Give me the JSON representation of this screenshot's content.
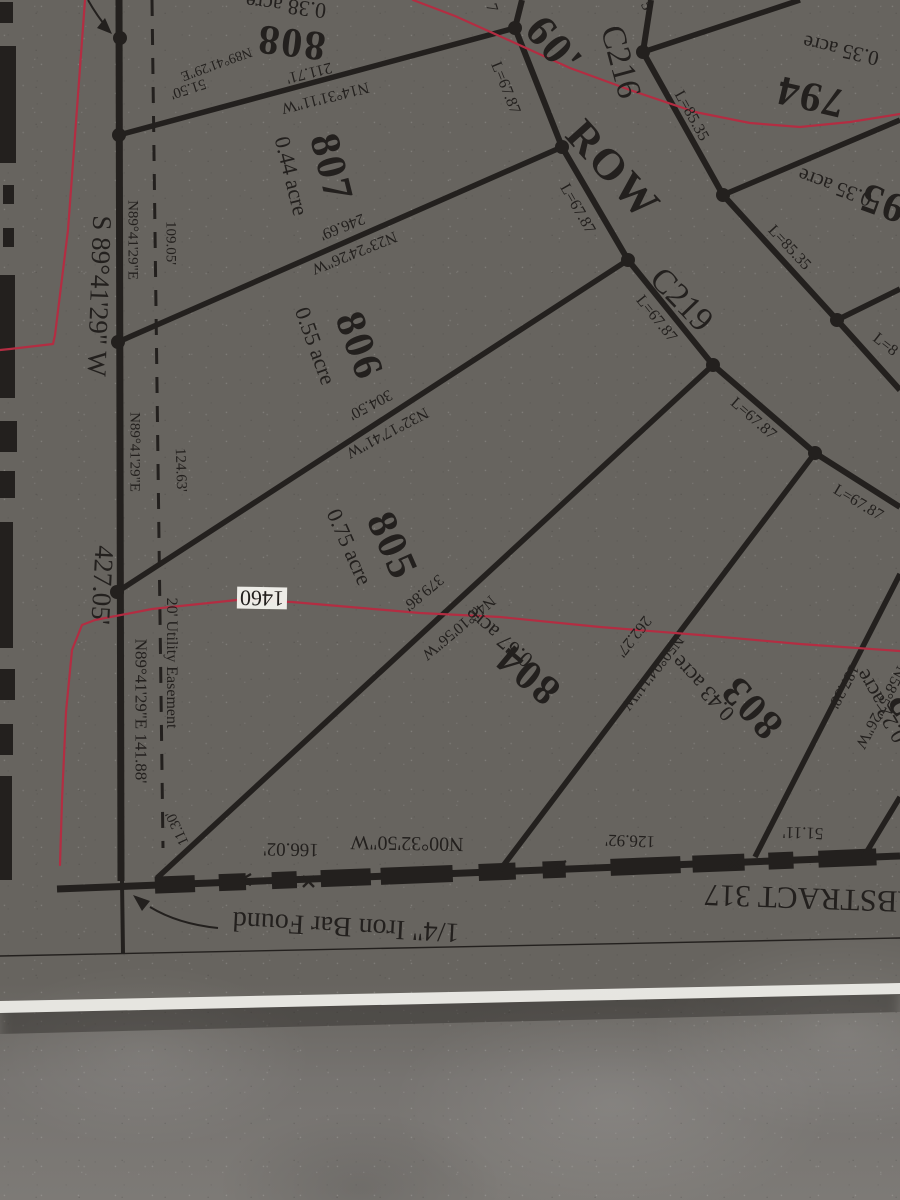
{
  "colors": {
    "ink": "#23201e",
    "red": "#b32d42",
    "paper": "#f1f0eb",
    "floor": "#67645f"
  },
  "map": {
    "type": "plat-survey-sheet",
    "street_curves": [
      "C216",
      "C219"
    ],
    "right_of_way": "60' ROW",
    "abstract": "ABSTRACT 317",
    "contour_elevation": "1460",
    "lots": [
      {
        "number": "794",
        "acreage": "0.35 acre"
      },
      {
        "number": "795",
        "acreage": "0.35 acre"
      },
      {
        "number": "802",
        "acreage": "0.22 acre"
      },
      {
        "number": "803",
        "acreage": "0.43 acre"
      },
      {
        "number": "804",
        "acreage": "0.67 acre"
      },
      {
        "number": "805",
        "acreage": "0.75 acre"
      },
      {
        "number": "806",
        "acreage": "0.55 acre"
      },
      {
        "number": "807",
        "acreage": "0.44 acre"
      },
      {
        "number": "808",
        "acreage": "0.38 acre"
      }
    ]
  },
  "labels": [
    {
      "name": "lot-808-number",
      "text": "808",
      "x": 291,
      "y": 42,
      "r": 187,
      "s": 42,
      "cls": "big"
    },
    {
      "name": "lot-808-acreage",
      "text": "0.38 acre",
      "x": 286,
      "y": 6,
      "r": 187,
      "s": 22
    },
    {
      "name": "lot-807-number",
      "text": "807",
      "x": 331,
      "y": 168,
      "r": 76,
      "s": 42,
      "cls": "big"
    },
    {
      "name": "lot-807-acreage",
      "text": "0.44 acre",
      "x": 291,
      "y": 176,
      "r": 76,
      "s": 22
    },
    {
      "name": "lot-806-number",
      "text": "806",
      "x": 359,
      "y": 346,
      "r": 70,
      "s": 42,
      "cls": "big"
    },
    {
      "name": "lot-806-acreage",
      "text": "0.55 acre",
      "x": 315,
      "y": 346,
      "r": 70,
      "s": 22
    },
    {
      "name": "lot-805-number",
      "text": "805",
      "x": 392,
      "y": 546,
      "r": 66,
      "s": 42,
      "cls": "big"
    },
    {
      "name": "lot-805-acreage",
      "text": "0.75 acre",
      "x": 349,
      "y": 547,
      "r": 66,
      "s": 22
    },
    {
      "name": "lot-804-number",
      "text": "804",
      "x": 528,
      "y": 674,
      "r": 220,
      "s": 42,
      "cls": "big"
    },
    {
      "name": "lot-804-acreage",
      "text": "0.67 acre",
      "x": 499,
      "y": 637,
      "r": 220,
      "s": 22
    },
    {
      "name": "lot-803-number",
      "text": "803",
      "x": 752,
      "y": 707,
      "r": 227,
      "s": 42,
      "cls": "big"
    },
    {
      "name": "lot-803-acreage",
      "text": "0.43 acre",
      "x": 703,
      "y": 688,
      "r": 227,
      "s": 22
    },
    {
      "name": "lot-802-number",
      "text": "802",
      "x": 916,
      "y": 721,
      "r": 237,
      "s": 42,
      "cls": "big"
    },
    {
      "name": "lot-802-acreage",
      "text": "0.22 acre",
      "x": 881,
      "y": 706,
      "r": 240,
      "s": 22
    },
    {
      "name": "lot-794-number",
      "text": "794",
      "x": 810,
      "y": 96,
      "r": 193,
      "s": 42,
      "cls": "big"
    },
    {
      "name": "lot-794-acreage",
      "text": "0.35 acre",
      "x": 841,
      "y": 50,
      "r": 193,
      "s": 21
    },
    {
      "name": "lot-795-number",
      "text": "795",
      "x": 893,
      "y": 206,
      "r": 200,
      "s": 42,
      "cls": "big"
    },
    {
      "name": "lot-795-acreage",
      "text": "0.35 acre",
      "x": 835,
      "y": 187,
      "r": 200,
      "s": 21
    },
    {
      "name": "row-width-label",
      "text": "60'",
      "x": 554,
      "y": 46,
      "r": 50,
      "s": 44,
      "cls": "big"
    },
    {
      "name": "row-label",
      "text": "ROW",
      "x": 613,
      "y": 170,
      "r": 48,
      "s": 44,
      "cls": "big"
    },
    {
      "name": "curve-c216-label",
      "text": "C216",
      "x": 620,
      "y": 62,
      "r": 75,
      "s": 34
    },
    {
      "name": "curve-c219-label",
      "text": "C219",
      "x": 681,
      "y": 300,
      "r": 46,
      "s": 34
    },
    {
      "name": "arc-length-67-a",
      "text": "L=67.87",
      "x": 505,
      "y": 88,
      "r": 68,
      "s": 16
    },
    {
      "name": "arc-length-67-b",
      "text": "L=67.87",
      "x": 577,
      "y": 209,
      "r": 60,
      "s": 16
    },
    {
      "name": "arc-length-67-c",
      "text": "L=67.87",
      "x": 656,
      "y": 319,
      "r": 51,
      "s": 16
    },
    {
      "name": "arc-length-67-d",
      "text": "L=67.87",
      "x": 753,
      "y": 419,
      "r": 41,
      "s": 16
    },
    {
      "name": "arc-length-67-e",
      "text": "L=67.87",
      "x": 858,
      "y": 503,
      "r": 31,
      "s": 16
    },
    {
      "name": "arc-length-partial-7",
      "text": "7",
      "x": 491,
      "y": 8,
      "r": 72,
      "s": 16
    },
    {
      "name": "arc-length-85-a",
      "text": "L=85.35",
      "x": 691,
      "y": 116,
      "r": 61,
      "s": 16
    },
    {
      "name": "arc-length-85-b",
      "text": "L=85.35",
      "x": 789,
      "y": 248,
      "r": 47,
      "s": 16
    },
    {
      "name": "arc-length-partial-l8",
      "text": "L=8",
      "x": 885,
      "y": 345,
      "r": 38,
      "s": 16
    },
    {
      "name": "arc-length-partial-5",
      "text": "5",
      "x": 646,
      "y": 6,
      "r": 65,
      "s": 16
    },
    {
      "name": "dim-211-71",
      "text": "211.71'",
      "x": 309,
      "y": 72,
      "r": 166,
      "s": 16
    },
    {
      "name": "bearing-n14-31-11",
      "text": "N14°31'11\"W",
      "x": 325,
      "y": 97,
      "r": 166,
      "s": 16
    },
    {
      "name": "dim-246-69",
      "text": "246.69'",
      "x": 342,
      "y": 226,
      "r": 158,
      "s": 16
    },
    {
      "name": "bearing-n23-24-26",
      "text": "N23°24'26\"W",
      "x": 354,
      "y": 252,
      "r": 158,
      "s": 16
    },
    {
      "name": "dim-304-50",
      "text": "304.50'",
      "x": 370,
      "y": 404,
      "r": 152,
      "s": 16
    },
    {
      "name": "bearing-n32-17-41",
      "text": "N32°17'41\"W",
      "x": 387,
      "y": 432,
      "r": 152,
      "s": 16
    },
    {
      "name": "dim-379-86",
      "text": "379.86'",
      "x": 423,
      "y": 592,
      "r": 140,
      "s": 16
    },
    {
      "name": "bearing-n41-10-56",
      "text": "N41°10'56\"W",
      "x": 458,
      "y": 627,
      "r": 140,
      "s": 16
    },
    {
      "name": "dim-262-27",
      "text": "262.27'",
      "x": 633,
      "y": 636,
      "r": 128,
      "s": 16
    },
    {
      "name": "bearing-n50-04-11",
      "text": "N50°04'11\"W",
      "x": 652,
      "y": 672,
      "r": 128,
      "s": 16
    },
    {
      "name": "dim-187-38",
      "text": "187.38'",
      "x": 843,
      "y": 686,
      "r": 118,
      "s": 16
    },
    {
      "name": "bearing-n58-57-26",
      "text": "N58°57'26\"W",
      "x": 880,
      "y": 707,
      "r": 118,
      "s": 16
    },
    {
      "name": "bearing-top-n89",
      "text": "N89°41'29\"E",
      "x": 216,
      "y": 63,
      "r": 160,
      "s": 14
    },
    {
      "name": "dim-51-50",
      "text": "51.50'",
      "x": 188,
      "y": 88,
      "r": 162,
      "s": 15
    },
    {
      "name": "bearing-left-n89-a",
      "text": "N89°41'29\"E",
      "x": 132,
      "y": 240,
      "r": 90,
      "s": 15
    },
    {
      "name": "dim-109-05",
      "text": "109.05'",
      "x": 170,
      "y": 243,
      "r": 90,
      "s": 15
    },
    {
      "name": "bearing-left-n89-b",
      "text": "N89°41'29\"E",
      "x": 134,
      "y": 452,
      "r": 90,
      "s": 15
    },
    {
      "name": "dim-124-63",
      "text": "124.63'",
      "x": 180,
      "y": 470,
      "r": 88,
      "s": 15
    },
    {
      "name": "bearing-s89-west-boundary",
      "text": "S 89°41'29\" W",
      "x": 99,
      "y": 296,
      "r": 92,
      "s": 27
    },
    {
      "name": "dim-427-05",
      "text": "427.05'",
      "x": 102,
      "y": 585,
      "r": 93,
      "s": 27
    },
    {
      "name": "utility-easement-label",
      "text": "20' Utility Easement",
      "x": 171,
      "y": 663,
      "r": 90,
      "s": 16
    },
    {
      "name": "bearing-left-n89-c",
      "text": "N89°41'29\"E  141.88'",
      "x": 141,
      "y": 711,
      "r": 90,
      "s": 17
    },
    {
      "name": "dim-11-30",
      "text": "11.30'",
      "x": 178,
      "y": 828,
      "r": 245,
      "s": 15
    },
    {
      "name": "contour-1460-label",
      "text": "1460",
      "x": 262,
      "y": 598,
      "r": 181,
      "s": 22,
      "cls": "halo"
    },
    {
      "name": "bearing-bottom-n00",
      "text": "N00°32'50\"W",
      "x": 407,
      "y": 843,
      "r": 181,
      "s": 20
    },
    {
      "name": "dim-166-02",
      "text": "166.02'",
      "x": 291,
      "y": 849,
      "r": 181,
      "s": 19
    },
    {
      "name": "dim-126-92",
      "text": "126.92'",
      "x": 630,
      "y": 841,
      "r": 182,
      "s": 17
    },
    {
      "name": "dim-51-11",
      "text": "51.11'",
      "x": 803,
      "y": 833,
      "r": 182,
      "s": 17
    },
    {
      "name": "abstract-317-label",
      "text": "ABSTRACT 317",
      "x": 812,
      "y": 899,
      "r": 182,
      "s": 31
    },
    {
      "name": "iron-bar-found-note",
      "text": "1/4\" Iron Bar Found",
      "x": 346,
      "y": 926,
      "r": 183,
      "s": 28
    }
  ]
}
